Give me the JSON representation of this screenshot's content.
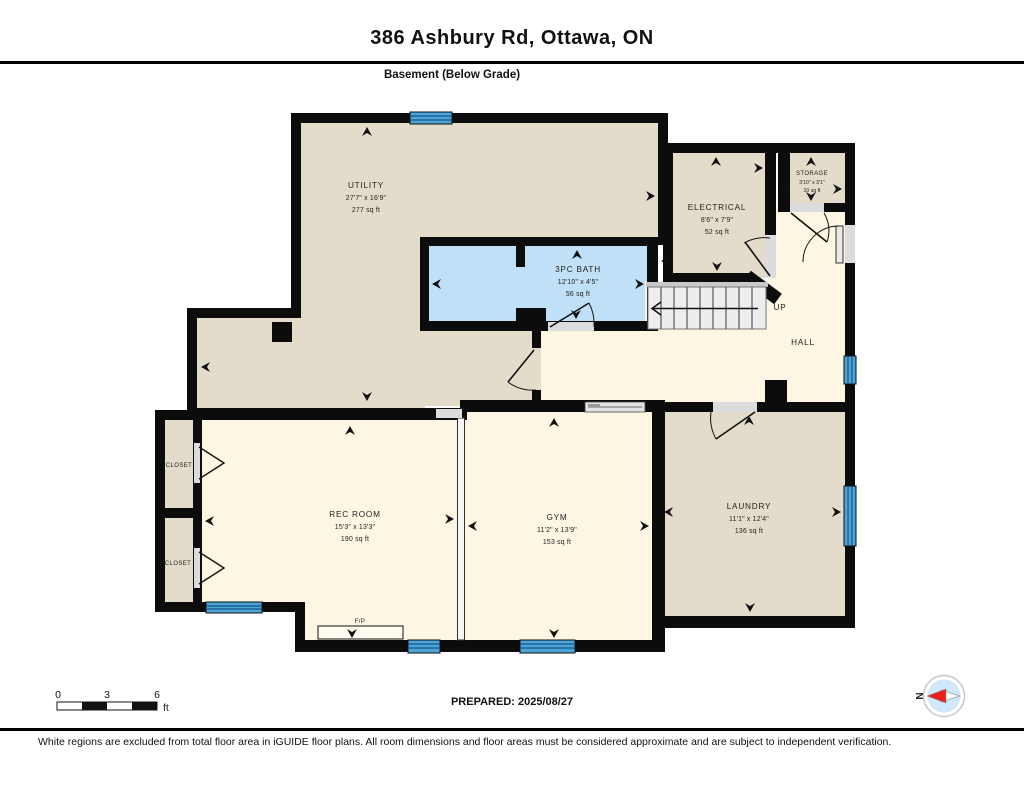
{
  "header": {
    "title": "386 Ashbury Rd, Ottawa, ON",
    "subtitle": "Basement (Below Grade)"
  },
  "rooms": {
    "utility": {
      "name": "UTILITY",
      "dims": "27'7\" x 16'9\"",
      "area": "277 sq ft"
    },
    "bath": {
      "name": "3PC BATH",
      "dims": "12'10\" x 4'5\"",
      "area": "56 sq ft"
    },
    "electrical": {
      "name": "ELECTRICAL",
      "dims": "8'6\" x 7'9\"",
      "area": "52 sq ft"
    },
    "storage": {
      "name": "STORAGE",
      "dims": "3'10\" x 3'1\"",
      "area": "10 sq ft"
    },
    "hall": {
      "name": "HALL"
    },
    "stairs": {
      "label": "UP"
    },
    "rec_room": {
      "name": "REC ROOM",
      "dims": "15'3\" x 13'3\"",
      "area": "190 sq ft"
    },
    "gym": {
      "name": "GYM",
      "dims": "11'2\" x 13'9\"",
      "area": "153 sq ft"
    },
    "laundry": {
      "name": "LAUNDRY",
      "dims": "11'1\" x 12'4\"",
      "area": "136 sq ft"
    },
    "closet_upper": {
      "name": "CLOSET"
    },
    "closet_lower": {
      "name": "CLOSET"
    },
    "fireplace": {
      "label": "F/P"
    }
  },
  "scale_bar": {
    "start": "0",
    "mid": "3",
    "end": "6",
    "unit": "ft"
  },
  "compass": {
    "north": "N"
  },
  "footer": {
    "prepared": "PREPARED: 2025/08/27",
    "disclaimer": "White regions are excluded from total floor area in iGUIDE floor plans. All room dimensions and floor areas must be considered approximate and are subject to independent verification."
  },
  "colors": {
    "wall": "#0c0c0c",
    "room_beige": "#e3dccb",
    "room_cream": "#fdf6e2",
    "bath_blue": "#bfe0f6",
    "window_blue": "#4da4d9",
    "compass_red": "#e8211d"
  }
}
